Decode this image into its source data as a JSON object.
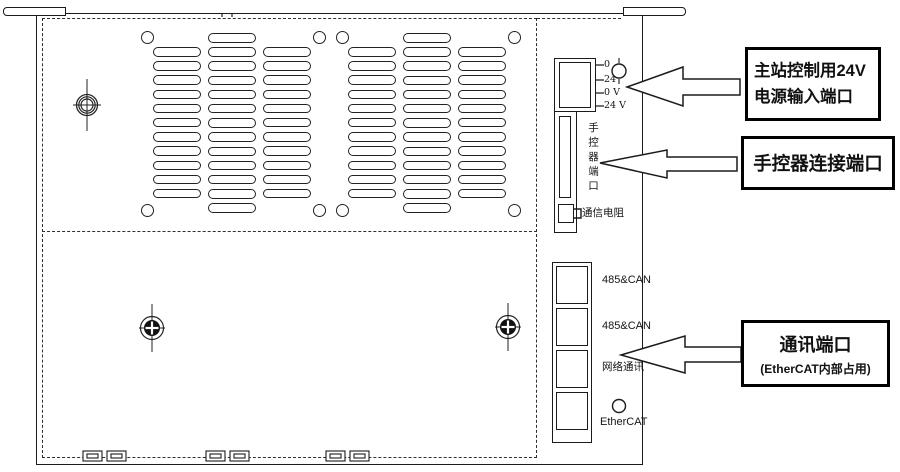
{
  "device": {
    "power_terminal": {
      "pin_labels": [
        "0",
        "24",
        "0 V",
        "24 V"
      ]
    },
    "hand_controller_port": {
      "label": "手控器端口"
    },
    "comm_resistor": {
      "label": "通信电阻"
    },
    "comm_ports": {
      "labels": [
        "485&CAN",
        "485&CAN",
        "网络通讯",
        "EtherCAT"
      ]
    }
  },
  "callouts": {
    "power": {
      "line1": "主站控制用24V",
      "line2": "电源输入端口"
    },
    "hand_controller": {
      "line1": "手控器连接端口"
    },
    "comm": {
      "line1": "通讯端口",
      "line2": "(EtherCAT内部占用)"
    }
  }
}
